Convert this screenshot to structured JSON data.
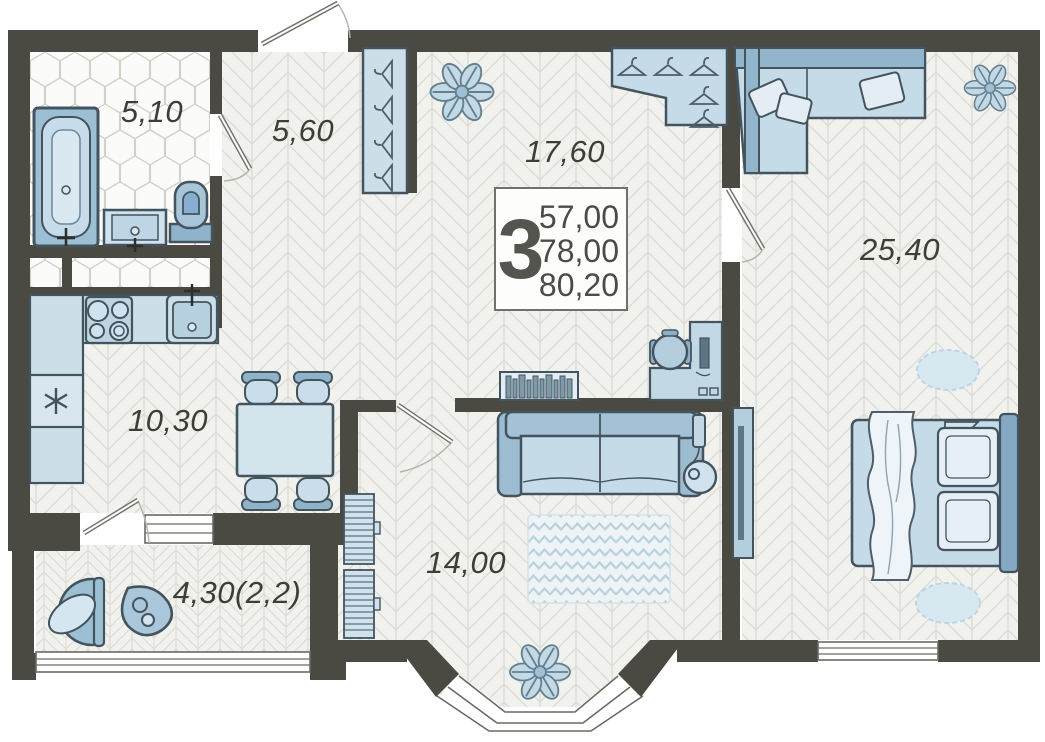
{
  "plan": {
    "title": "3-room apartment floor plan",
    "badge": {
      "rooms": "3",
      "areas": [
        "57,00",
        "78,00",
        "80,20"
      ]
    },
    "rooms": [
      {
        "id": "bathroom",
        "area": "5,10"
      },
      {
        "id": "hallway",
        "area": "5,60"
      },
      {
        "id": "living",
        "area": "17,60"
      },
      {
        "id": "bedroom",
        "area": "25,40"
      },
      {
        "id": "kitchen",
        "area": "10,30"
      },
      {
        "id": "lounge",
        "area": "14,00"
      },
      {
        "id": "balcony",
        "area": "4,30(2,2)"
      }
    ],
    "colors": {
      "wall": "#4a4a43",
      "floor": "#f1f1ee",
      "furniture_light": "#cfe2ed",
      "furniture_mid": "#aac7d9",
      "outline": "#44545e",
      "label": "#3e3e39"
    }
  }
}
